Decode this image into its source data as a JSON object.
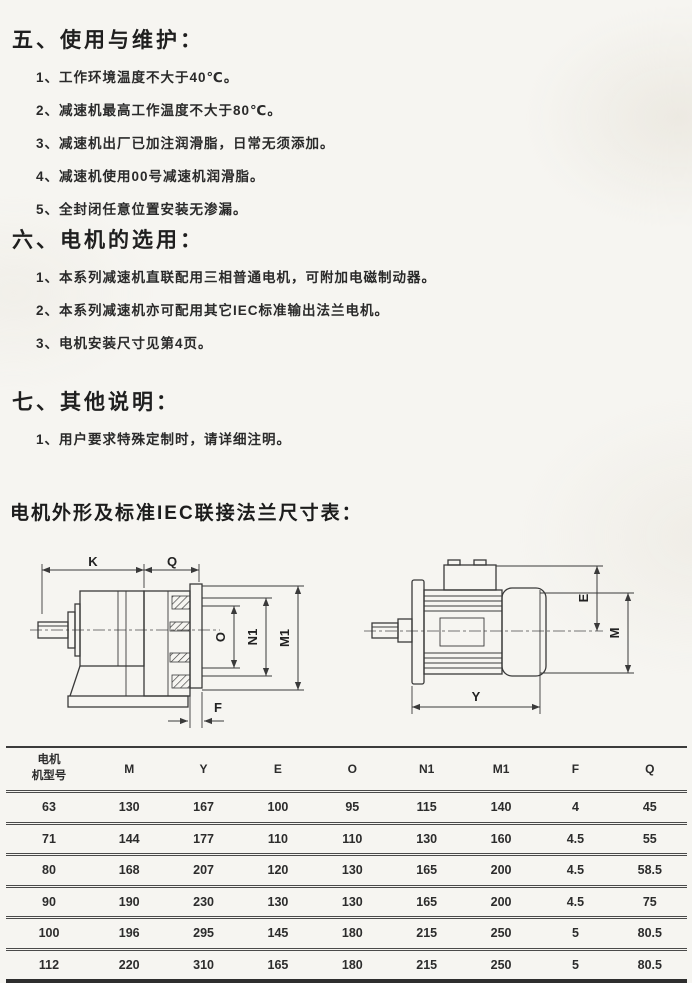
{
  "colors": {
    "paper": "#f6f5f1",
    "ink": "#262626",
    "line": "#3a3a3a"
  },
  "sections": [
    {
      "title": "五、使用与维护：",
      "items": [
        "1、工作环境温度不大于40℃。",
        "2、减速机最高工作温度不大于80℃。",
        "3、减速机出厂已加注润滑脂，日常无须添加。",
        "4、减速机使用00号减速机润滑脂。",
        "5、全封闭任意位置安装无渗漏。"
      ]
    },
    {
      "title": "六、电机的选用：",
      "items": [
        "1、本系列减速机直联配用三相普通电机，可附加电磁制动器。",
        "2、本系列减速机亦可配用其它IEC标准输出法兰电机。",
        "3、电机安装尺寸见第4页。"
      ]
    },
    {
      "title": "七、其他说明：",
      "items": [
        "1、用户要求特殊定制时，请详细注明。"
      ]
    }
  ],
  "table_heading": "电机外形及标准IEC联接法兰尺寸表：",
  "drawings": {
    "left": {
      "k": "K",
      "q": "Q",
      "o": "O",
      "n1": "N1",
      "m1": "M1",
      "f": "F"
    },
    "right": {
      "e": "E",
      "m": "M",
      "y": "Y"
    }
  },
  "dimension_table": {
    "headers": [
      "电机\n机型号",
      "M",
      "Y",
      "E",
      "O",
      "N1",
      "M1",
      "F",
      "Q"
    ],
    "rows": [
      [
        "63",
        "130",
        "167",
        "100",
        "95",
        "115",
        "140",
        "4",
        "45"
      ],
      [
        "71",
        "144",
        "177",
        "110",
        "110",
        "130",
        "160",
        "4.5",
        "55"
      ],
      [
        "80",
        "168",
        "207",
        "120",
        "130",
        "165",
        "200",
        "4.5",
        "58.5"
      ],
      [
        "90",
        "190",
        "230",
        "130",
        "130",
        "165",
        "200",
        "4.5",
        "75"
      ],
      [
        "100",
        "196",
        "295",
        "145",
        "180",
        "215",
        "250",
        "5",
        "80.5"
      ],
      [
        "112",
        "220",
        "310",
        "165",
        "180",
        "215",
        "250",
        "5",
        "80.5"
      ]
    ]
  }
}
